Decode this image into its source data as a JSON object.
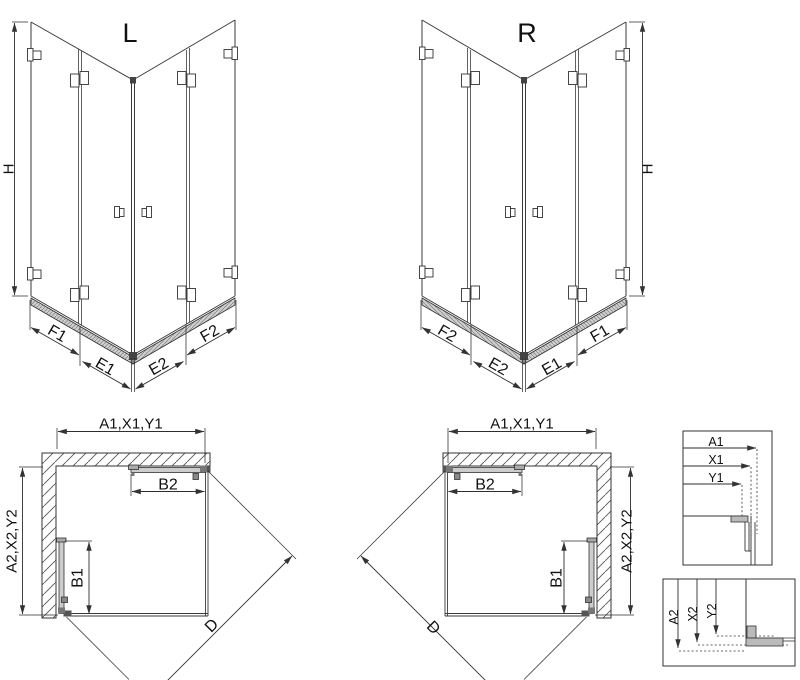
{
  "drawing": {
    "type": "shower-enclosure-technical-drawing",
    "colors": {
      "line": "#333333",
      "text": "#111111",
      "fill_gray": "#c9c9c9",
      "connector_dark": "#555555",
      "background": "#ffffff"
    }
  },
  "iso_left": {
    "view_label": "L",
    "height_label": "H",
    "segment_labels": [
      "F1",
      "E1",
      "E2",
      "F2"
    ]
  },
  "iso_right": {
    "view_label": "R",
    "height_label": "H",
    "segment_labels": [
      "F2",
      "E2",
      "E1",
      "F1"
    ]
  },
  "plan_left": {
    "width_label": "A1,X1,Y1",
    "depth_label": "A2,X2,Y2",
    "top_door_label": "B2",
    "side_door_label": "B1",
    "diagonal_label": "D"
  },
  "plan_right": {
    "width_label": "A1,X1,Y1",
    "depth_label": "A2,X2,Y2",
    "top_door_label": "B2",
    "side_door_label": "B1",
    "diagonal_label": "D"
  },
  "detail_width_box": {
    "labels": [
      "A1",
      "X1",
      "Y1"
    ]
  },
  "detail_depth_box": {
    "labels": [
      "A2",
      "X2",
      "Y2"
    ]
  }
}
